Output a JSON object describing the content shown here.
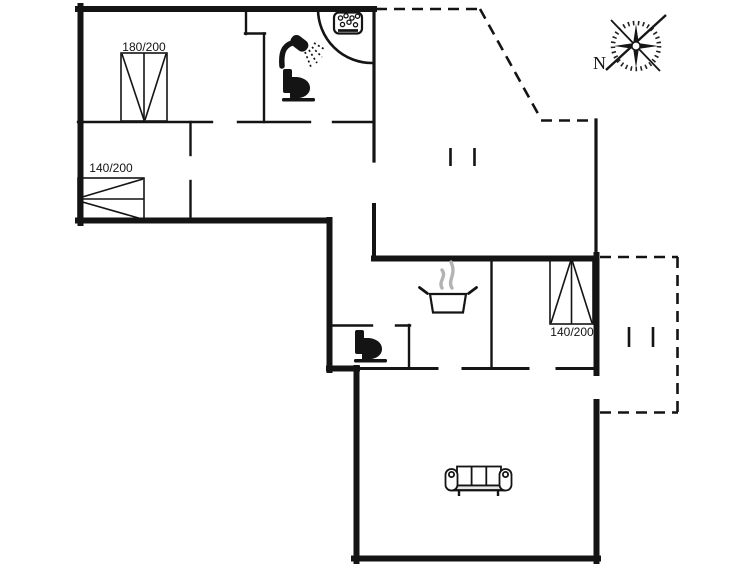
{
  "meta": {
    "type": "floor-plan",
    "background": "#ffffff",
    "wall_color": "#141414",
    "steam_color": "#b3b3b3"
  },
  "compass": {
    "label": "N",
    "direction": "north-pointing-lower-left"
  },
  "beds": {
    "top_left_bedroom": {
      "label": "180/200"
    },
    "mid_left_bedroom": {
      "label": "140/200"
    },
    "right_bedroom": {
      "label": "140/200"
    }
  },
  "icons": [
    {
      "name": "whirlpool-icon",
      "area": "bathroom-corner-tub"
    },
    {
      "name": "shower-icon",
      "area": "bathroom"
    },
    {
      "name": "toilet-icon",
      "area": "bathroom"
    },
    {
      "name": "toilet-icon",
      "area": "wc"
    },
    {
      "name": "cooking-pot-icon",
      "area": "kitchen"
    },
    {
      "name": "sofa-icon",
      "area": "living-room"
    },
    {
      "name": "steps-icon",
      "area": "entrance-terrace"
    },
    {
      "name": "steps-icon",
      "area": "side-terrace"
    },
    {
      "name": "compass-rose-icon",
      "area": "outside-top-right"
    }
  ],
  "terraces": {
    "style": "dashed-outline",
    "count": 2
  }
}
